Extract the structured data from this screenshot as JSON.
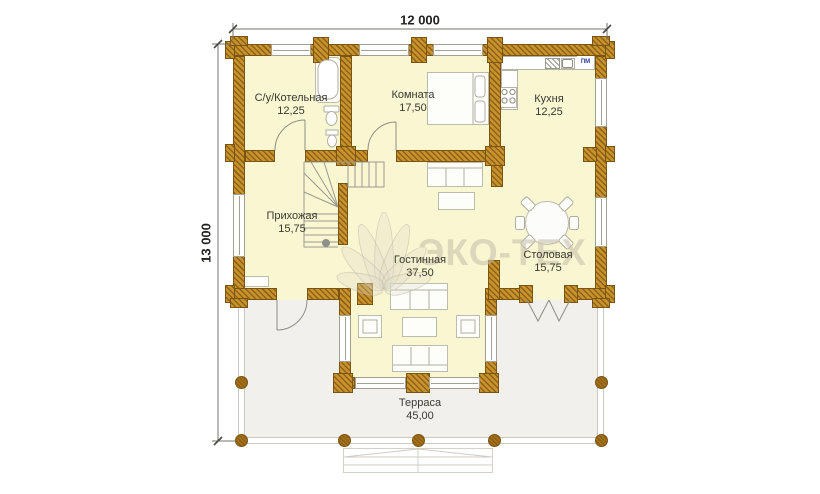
{
  "dimensions": {
    "width_label": "12 000",
    "height_label": "13 000"
  },
  "rooms": [
    {
      "id": "bathroom-boiler",
      "name": "С/у/Котельная",
      "area": "12,25"
    },
    {
      "id": "bedroom",
      "name": "Комната",
      "area": "17,50"
    },
    {
      "id": "kitchen",
      "name": "Кухня",
      "area": "12,25"
    },
    {
      "id": "hallway",
      "name": "Прихожая",
      "area": "15,75"
    },
    {
      "id": "living-room",
      "name": "Гостинная",
      "area": "37,50"
    },
    {
      "id": "dining-room",
      "name": "Столовая",
      "area": "15,75"
    },
    {
      "id": "terrace",
      "name": "Терраса",
      "area": "45,00"
    }
  ],
  "annotations": {
    "dishwasher_label": "ПМ"
  },
  "watermark": {
    "text": "ЭКО-ТЕХ"
  },
  "colors": {
    "wall_base": "#c8922e",
    "wall_hatch": "#8f6316",
    "wall_border": "#7a5511",
    "room_fill": "#f9f6d2",
    "terrace_fill": "#f1f0ec",
    "label_text": "#393931",
    "dimension_text": "#22221e",
    "dishwasher_text": "#2b3a9a",
    "watermark": "#c9c1ac"
  }
}
